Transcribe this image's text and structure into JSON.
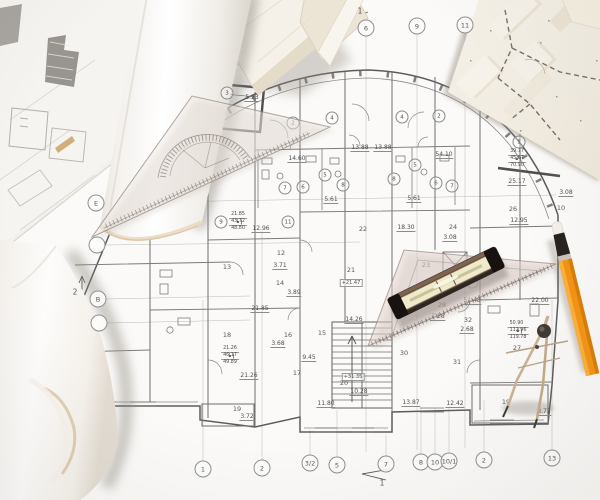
{
  "scene": {
    "kind": "photo of architectural blueprints with drafting tools",
    "objects": [
      "paper-roll",
      "curled-paper-roll",
      "site-plan-underlay",
      "floor-plan-sheet",
      "model-site-sheet",
      "foam-model-blocks",
      "protractor-set-square",
      "triangle-ruler",
      "spirit-level",
      "drafting-compass",
      "pencil"
    ],
    "colors": {
      "paper": "#fbfaf8",
      "plan_line": "#8a8a8a",
      "wall_line": "#5c5c5c",
      "kraft_edge": "#c79e63",
      "pencil_orange": "#f59312",
      "level_frame": "#3c312a",
      "level_vial": "#f0eacc",
      "compass_metal": "#c9b190"
    }
  },
  "plan": {
    "dim_labels": [
      {
        "t": "5.23",
        "x": 252,
        "y": 98
      },
      {
        "t": "14.60",
        "x": 297,
        "y": 159
      },
      {
        "t": "13.88",
        "x": 360,
        "y": 148
      },
      {
        "t": "13.88",
        "x": 383,
        "y": 148
      },
      {
        "t": "54.10",
        "x": 444,
        "y": 155
      },
      {
        "t": "25.17",
        "x": 517,
        "y": 182
      },
      {
        "t": "3.08",
        "x": 566,
        "y": 193
      },
      {
        "t": "5.61",
        "x": 331,
        "y": 200
      },
      {
        "t": "5.61",
        "x": 414,
        "y": 199
      },
      {
        "t": "12.95",
        "x": 519,
        "y": 221
      },
      {
        "t": "12.96",
        "x": 261,
        "y": 229
      },
      {
        "t": "18.30",
        "x": 406,
        "y": 228
      },
      {
        "t": "3.08",
        "x": 450,
        "y": 238
      },
      {
        "t": "21.85",
        "x": 260,
        "y": 309
      },
      {
        "t": "3.71",
        "x": 280,
        "y": 266
      },
      {
        "t": "3.89",
        "x": 294,
        "y": 293
      },
      {
        "t": "3.68",
        "x": 278,
        "y": 344
      },
      {
        "t": "14.26",
        "x": 354,
        "y": 320
      },
      {
        "t": "21.26",
        "x": 249,
        "y": 376
      },
      {
        "t": "9.45",
        "x": 309,
        "y": 358
      },
      {
        "t": "11.80",
        "x": 326,
        "y": 404
      },
      {
        "t": "10.28",
        "x": 359,
        "y": 392
      },
      {
        "t": "13.87",
        "x": 411,
        "y": 403
      },
      {
        "t": "12.42",
        "x": 455,
        "y": 404
      },
      {
        "t": "3.72",
        "x": 247,
        "y": 417
      },
      {
        "t": "3.72",
        "x": 544,
        "y": 412
      },
      {
        "t": "22.00",
        "x": 540,
        "y": 301
      },
      {
        "t": "51.48",
        "x": 472,
        "y": 301
      },
      {
        "t": "7.28",
        "x": 438,
        "y": 317
      },
      {
        "t": "2.68",
        "x": 467,
        "y": 330
      }
    ],
    "room_circles": [
      {
        "t": "3",
        "x": 227,
        "y": 93
      },
      {
        "t": "2",
        "x": 293,
        "y": 123
      },
      {
        "t": "4",
        "x": 332,
        "y": 118
      },
      {
        "t": "4",
        "x": 402,
        "y": 117
      },
      {
        "t": "2",
        "x": 439,
        "y": 116
      },
      {
        "t": "5",
        "x": 325,
        "y": 175
      },
      {
        "t": "5",
        "x": 415,
        "y": 165
      },
      {
        "t": "7",
        "x": 285,
        "y": 188
      },
      {
        "t": "6",
        "x": 303,
        "y": 187
      },
      {
        "t": "8",
        "x": 343,
        "y": 185
      },
      {
        "t": "8",
        "x": 394,
        "y": 179
      },
      {
        "t": "6",
        "x": 436,
        "y": 183
      },
      {
        "t": "7",
        "x": 452,
        "y": 186
      },
      {
        "t": "9",
        "x": 221,
        "y": 222
      },
      {
        "t": "11",
        "x": 288,
        "y": 222
      },
      {
        "t": "1",
        "x": 519,
        "y": 142
      }
    ],
    "room_plain": [
      {
        "t": "12",
        "x": 281,
        "y": 253
      },
      {
        "t": "13",
        "x": 227,
        "y": 267
      },
      {
        "t": "14",
        "x": 280,
        "y": 283
      },
      {
        "t": "15",
        "x": 322,
        "y": 333
      },
      {
        "t": "16",
        "x": 288,
        "y": 335
      },
      {
        "t": "17",
        "x": 297,
        "y": 373
      },
      {
        "t": "18",
        "x": 227,
        "y": 335
      },
      {
        "t": "19",
        "x": 237,
        "y": 409
      },
      {
        "t": "19",
        "x": 506,
        "y": 402
      },
      {
        "t": "20",
        "x": 344,
        "y": 383
      },
      {
        "t": "21",
        "x": 351,
        "y": 270
      },
      {
        "t": "22",
        "x": 363,
        "y": 229
      },
      {
        "t": "23",
        "x": 426,
        "y": 265
      },
      {
        "t": "24",
        "x": 453,
        "y": 227
      },
      {
        "t": "26",
        "x": 513,
        "y": 209
      },
      {
        "t": "27",
        "x": 517,
        "y": 348
      },
      {
        "t": "28",
        "x": 442,
        "y": 305
      },
      {
        "t": "30",
        "x": 404,
        "y": 353
      },
      {
        "t": "31",
        "x": 457,
        "y": 362
      },
      {
        "t": "32",
        "x": 468,
        "y": 320
      },
      {
        "t": "10",
        "x": 561,
        "y": 208
      }
    ],
    "level_marks": [
      {
        "t": "+21.47",
        "x": 351,
        "y": 283
      },
      {
        "t": "+31.35",
        "x": 353,
        "y": 377
      }
    ],
    "stat_boxes": [
      {
        "label": "1",
        "rows": [
          "21.85",
          "43.72",
          "48.80"
        ],
        "x": 238,
        "y": 222
      },
      {
        "label": "2",
        "rows": [
          "39.77",
          "45.67",
          "70.90"
        ],
        "x": 517,
        "y": 159
      },
      {
        "label": "1",
        "rows": [
          "21.26",
          "46.17",
          "49.89"
        ],
        "x": 230,
        "y": 356
      },
      {
        "label": "3",
        "rows": [
          "50.90",
          "112.96",
          "119.78"
        ],
        "x": 518,
        "y": 331
      }
    ],
    "grid_top": [
      {
        "t": "6",
        "x": 366,
        "y": 28
      },
      {
        "t": "9",
        "x": 417,
        "y": 26
      },
      {
        "t": "11",
        "x": 465,
        "y": 25
      }
    ],
    "grid_bottom": [
      {
        "t": "1",
        "x": 203,
        "y": 469
      },
      {
        "t": "2",
        "x": 262,
        "y": 468
      },
      {
        "t": "3/2",
        "x": 310,
        "y": 463
      },
      {
        "t": "5",
        "x": 337,
        "y": 465
      },
      {
        "t": "7",
        "x": 386,
        "y": 464
      },
      {
        "t": "8",
        "x": 421,
        "y": 462
      },
      {
        "t": "10",
        "x": 435,
        "y": 462
      },
      {
        "t": "10/1",
        "x": 449,
        "y": 461
      },
      {
        "t": "2",
        "x": 484,
        "y": 460
      },
      {
        "t": "13",
        "x": 552,
        "y": 458
      }
    ],
    "grid_left": [
      {
        "t": "E",
        "x": 96,
        "y": 203
      },
      {
        "t": "",
        "x": 97,
        "y": 245
      },
      {
        "t": "B",
        "x": 98,
        "y": 299
      },
      {
        "t": "",
        "x": 99,
        "y": 323
      }
    ],
    "axis_labels": [
      {
        "t": "1",
        "x": 360,
        "y": 11
      },
      {
        "t": "2",
        "x": 75,
        "y": 292
      },
      {
        "t": "1",
        "x": 382,
        "y": 483
      }
    ]
  }
}
